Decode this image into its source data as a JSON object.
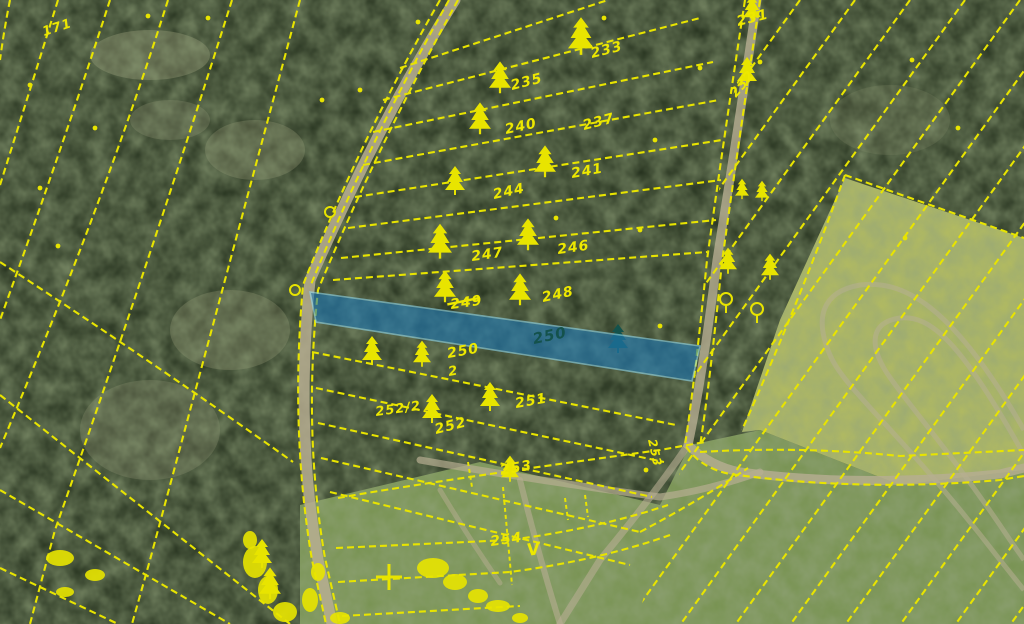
{
  "map": {
    "type": "cadastral-aerial-map",
    "highlight_parcel_label": "250"
  },
  "colors": {
    "overlay_yellow": "#e8e400",
    "label_yellow": "#ede800",
    "label_in_blue": "#14524c",
    "highlight_fill": "#1f7ab8",
    "highlight_stroke": "#8fd8ee",
    "forest_base": "#24301d",
    "forest_mottle": "#4a5c33",
    "field_green": "#7f9b55",
    "field_bright": "#bdc463",
    "road_tan": "#b7ae92",
    "bare_tan": "#8f8f6f"
  },
  "parcel_labels": [
    {
      "text": "171",
      "x": 44,
      "y": 36,
      "rot": -18,
      "size": 13
    },
    {
      "text": "231",
      "x": 738,
      "y": 26,
      "rot": -14,
      "size": 14
    },
    {
      "text": "233",
      "x": 592,
      "y": 58,
      "rot": -14,
      "size": 14
    },
    {
      "text": "232",
      "x": 736,
      "y": 98,
      "rot": -50,
      "size": 13
    },
    {
      "text": "235",
      "x": 512,
      "y": 90,
      "rot": -14,
      "size": 14
    },
    {
      "text": "240",
      "x": 506,
      "y": 134,
      "rot": -12,
      "size": 14
    },
    {
      "text": "237",
      "x": 584,
      "y": 130,
      "rot": -14,
      "size": 14
    },
    {
      "text": "241",
      "x": 572,
      "y": 178,
      "rot": -10,
      "size": 14
    },
    {
      "text": "244",
      "x": 494,
      "y": 199,
      "rot": -12,
      "size": 14
    },
    {
      "text": "246",
      "x": 558,
      "y": 254,
      "rot": -8,
      "size": 14
    },
    {
      "text": "247",
      "x": 472,
      "y": 261,
      "rot": -8,
      "size": 14
    },
    {
      "text": "248",
      "x": 543,
      "y": 302,
      "rot": -12,
      "size": 14
    },
    {
      "text": "249",
      "x": 451,
      "y": 309,
      "rot": -8,
      "size": 14,
      "strike": true
    },
    {
      "text": "250",
      "x": 534,
      "y": 344,
      "rot": -12,
      "size": 15,
      "in_blue": true
    },
    {
      "text": "250",
      "x": 448,
      "y": 358,
      "rot": -10,
      "size": 14
    },
    {
      "text": "2",
      "x": 449,
      "y": 376,
      "rot": -10,
      "size": 13
    },
    {
      "text": "251",
      "x": 516,
      "y": 408,
      "rot": -10,
      "size": 14
    },
    {
      "text": "252/2",
      "x": 376,
      "y": 416,
      "rot": -8,
      "size": 13
    },
    {
      "text": "252",
      "x": 436,
      "y": 434,
      "rot": -14,
      "size": 14
    },
    {
      "text": "253",
      "x": 501,
      "y": 475,
      "rot": -10,
      "size": 14
    },
    {
      "text": "253",
      "x": 648,
      "y": 440,
      "rot": 78,
      "size": 12
    },
    {
      "text": "254",
      "x": 491,
      "y": 546,
      "rot": -8,
      "size": 14
    },
    {
      "text": "V",
      "x": 528,
      "y": 556,
      "rot": -10,
      "size": 17
    }
  ],
  "highlight_parcel": {
    "points": "310,292 700,346 692,381 316,322"
  },
  "overlay": {
    "fan_paths": [
      "M10,0 Q4,30 0,60",
      "M58,0 Q30,90 0,185",
      "M110,0 Q65,140 0,320",
      "M168,0 Q105,200 0,448",
      "M232,0 Q150,260 55,530 L30,624",
      "M300,0 Q225,280 150,560 L132,624",
      "M0,262 Q150,360 293,462",
      "M0,395 L290,624",
      "M0,490 L230,624",
      "M0,568 L118,624"
    ],
    "road_flank_paths": [
      "M440,0 Q360,140 303,285 Q290,430 312,560 L326,624",
      "M458,0 Q378,145 318,290 Q303,432 325,558 L340,624",
      "M449,0 Q369,142 310,287"
    ],
    "rung_paths": [
      "M400,68 L608,0",
      "M383,100 L700,18",
      "M373,132 L713,62",
      "M363,165 L719,100",
      "M355,197 L722,140",
      "M348,228 L721,180",
      "M341,258 L716,220",
      "M333,280 L707,252",
      "M312,352 L676,425",
      "M316,388 L664,462",
      "M318,423 L652,497",
      "M321,458 L640,532",
      "M330,492 L630,565"
    ],
    "field_paths": [
      "M338,498 Q420,483 660,450 L705,442",
      "M336,548 L510,540 Q600,528 668,505",
      "M338,582 L510,572 Q600,560 670,535",
      "M342,616 L520,606",
      "M640,532 Q700,500 748,468"
    ],
    "east_boundary_paths": [
      "M745,0 Q725,130 707,260 Q695,380 685,445 Q700,468 730,474 Q860,492 1000,480 L1024,476",
      "M760,0 Q740,132 722,262 Q710,382 700,446",
      "M845,175 Q800,300 742,430",
      "M845,175 L1024,238",
      "M700,452 Q800,446 900,456 L1024,450"
    ],
    "right_family_x0": [
      800,
      855,
      910,
      965,
      1020,
      1075,
      1130,
      1185,
      1240,
      1295,
      1350,
      1405,
      1460
    ],
    "right_family_slope": 0.72,
    "right_clip": "748,0 1024,0 1024,624 636,624 686,452 708,262",
    "short_lines": [
      [
        503,
        487,
        512,
        585
      ],
      [
        565,
        498,
        568,
        520
      ],
      [
        585,
        495,
        588,
        517
      ],
      [
        468,
        462,
        472,
        487
      ]
    ],
    "circles": [
      [
        330,
        212
      ],
      [
        295,
        290
      ]
    ],
    "cross_symbols": [
      [
        389,
        577
      ]
    ],
    "dots": [
      [
        148,
        16
      ],
      [
        95,
        128
      ],
      [
        40,
        188
      ],
      [
        58,
        246
      ],
      [
        30,
        85
      ],
      [
        322,
        100
      ],
      [
        360,
        90
      ],
      [
        208,
        18
      ],
      [
        418,
        22
      ],
      [
        640,
        230
      ],
      [
        655,
        140
      ],
      [
        700,
        68
      ],
      [
        912,
        60
      ],
      [
        958,
        128
      ],
      [
        905,
        238
      ],
      [
        660,
        326
      ],
      [
        760,
        62
      ],
      [
        604,
        18
      ],
      [
        556,
        218
      ],
      [
        646,
        470
      ]
    ],
    "blobs": [
      [
        60,
        558,
        14,
        8
      ],
      [
        95,
        575,
        10,
        6
      ],
      [
        255,
        562,
        12,
        16
      ],
      [
        268,
        590,
        10,
        14
      ],
      [
        285,
        612,
        12,
        10
      ],
      [
        310,
        600,
        8,
        12
      ],
      [
        318,
        572,
        7,
        9
      ],
      [
        340,
        618,
        10,
        6
      ],
      [
        433,
        568,
        16,
        10
      ],
      [
        455,
        582,
        12,
        8
      ],
      [
        478,
        596,
        10,
        7
      ],
      [
        498,
        606,
        12,
        6
      ],
      [
        520,
        618,
        8,
        5
      ],
      [
        250,
        540,
        7,
        9
      ],
      [
        65,
        592,
        9,
        5
      ]
    ],
    "trees": [
      [
        581,
        38,
        1.3,
        "c"
      ],
      [
        752,
        10,
        0.9,
        "c"
      ],
      [
        747,
        73,
        1.0,
        "c"
      ],
      [
        500,
        79,
        1.1,
        "c"
      ],
      [
        480,
        120,
        1.1,
        "c"
      ],
      [
        545,
        163,
        1.1,
        "c"
      ],
      [
        455,
        182,
        1.0,
        "c"
      ],
      [
        440,
        243,
        1.2,
        "c"
      ],
      [
        528,
        236,
        1.1,
        "c"
      ],
      [
        445,
        288,
        1.1,
        "c"
      ],
      [
        520,
        291,
        1.1,
        "c"
      ],
      [
        618,
        340,
        1.0,
        "b"
      ],
      [
        372,
        352,
        1.0,
        "c"
      ],
      [
        422,
        355,
        0.9,
        "c"
      ],
      [
        432,
        410,
        1.0,
        "c"
      ],
      [
        490,
        398,
        1.0,
        "c"
      ],
      [
        510,
        470,
        0.9,
        "c"
      ],
      [
        728,
        262,
        0.9,
        "c"
      ],
      [
        770,
        268,
        0.9,
        "c"
      ],
      [
        726,
        305,
        1.0,
        "d"
      ],
      [
        757,
        315,
        1.0,
        "d"
      ],
      [
        742,
        190,
        0.7,
        "c"
      ],
      [
        762,
        192,
        0.7,
        "c"
      ],
      [
        262,
        555,
        1.0,
        "c"
      ],
      [
        270,
        585,
        1.1,
        "c"
      ]
    ]
  },
  "photo": {
    "fields": [
      {
        "name": "bottom-field",
        "points": "300,505 480,462 660,505 690,445 760,430 900,485 1024,470 1024,624 300,624",
        "color": "#7f9b55",
        "op": 0.92
      },
      {
        "name": "bright-field",
        "points": "845,178 1024,238 1024,470 900,485 760,430 742,432 780,320",
        "color": "#bdc463",
        "op": 0.95
      }
    ],
    "bare_patches": [
      [
        150,
        55,
        60,
        25,
        0.45
      ],
      [
        255,
        150,
        50,
        30,
        0.35
      ],
      [
        170,
        120,
        40,
        20,
        0.3
      ],
      [
        230,
        330,
        60,
        40,
        0.35
      ],
      [
        150,
        430,
        70,
        50,
        0.3
      ],
      [
        890,
        120,
        60,
        35,
        0.2
      ]
    ],
    "roads": [
      {
        "d": "M455,0 Q380,120 310,280 Q295,430 318,560 L332,624",
        "w": 11,
        "op": 0.85
      },
      {
        "d": "M757,0 Q738,130 717,260 Q702,380 688,445 Q710,466 740,472 Q860,488 1000,474 L1024,468",
        "w": 9,
        "op": 0.8
      },
      {
        "d": "M688,445 Q650,500 600,560 L560,624",
        "w": 7,
        "op": 0.6
      },
      {
        "d": "M420,460 Q533,480 660,497 Q710,490 760,472",
        "w": 7,
        "op": 0.7
      },
      {
        "d": "M520,480 Q540,560 560,624",
        "w": 6,
        "op": 0.6
      },
      {
        "d": "M440,490 Q470,540 500,583",
        "w": 5,
        "op": 0.5
      }
    ],
    "tracks": [
      "M1024,430 C950,300 900,280 860,285 C820,292 815,320 830,355 C845,390 900,430 1000,560 L1024,590",
      "M1024,455 C960,340 930,315 900,318 C870,322 870,345 885,370 C900,395 950,450 1010,540 L1024,560"
    ]
  }
}
